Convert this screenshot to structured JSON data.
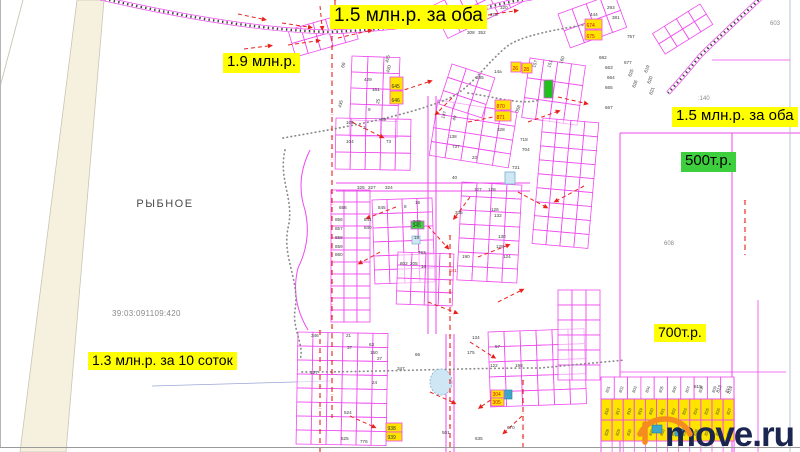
{
  "map": {
    "place_label": "РЫБНОЕ",
    "cadastral_number": "39:03:091109:420",
    "price_labels": [
      {
        "text": "1.5 млн.р. за оба",
        "x": 330,
        "y": 5,
        "fs": 19,
        "bg": "yellow"
      },
      {
        "text": "1.9 млн.р.",
        "x": 223,
        "y": 53,
        "fs": 15,
        "bg": "yellow"
      },
      {
        "text": "1.5 млн.р. за оба",
        "x": 672,
        "y": 107,
        "fs": 15,
        "bg": "yellow"
      },
      {
        "text": "500т.р.",
        "x": 681,
        "y": 152,
        "fs": 15,
        "bg": "green"
      },
      {
        "text": "700т.р.",
        "x": 654,
        "y": 324,
        "fs": 14,
        "bg": "yellow"
      },
      {
        "text": "1.3 млн.р. за 10 соток",
        "x": 88,
        "y": 352,
        "fs": 14,
        "bg": "yellow"
      }
    ],
    "area_codes": [
      {
        "t": "603",
        "x": 770,
        "y": 25
      },
      {
        "t": ":140",
        "x": 698,
        "y": 100
      },
      {
        "t": "608",
        "x": 664,
        "y": 245
      }
    ],
    "parcel_numbers": [
      [
        "429",
        364,
        81,
        0
      ],
      [
        "161",
        372,
        91,
        0
      ],
      [
        "435",
        341,
        108,
        -75
      ],
      [
        "60",
        344,
        68,
        -75
      ],
      [
        "425",
        388,
        63,
        -75
      ],
      [
        "420",
        389,
        73,
        -75
      ],
      [
        "25",
        379,
        104,
        -80
      ],
      [
        "9",
        368,
        111,
        0
      ],
      [
        "69",
        381,
        121,
        0
      ],
      [
        "105",
        346,
        124,
        0
      ],
      [
        "2",
        363,
        129,
        0
      ],
      [
        "104",
        346,
        143,
        0
      ],
      [
        "73",
        386,
        143,
        0
      ],
      [
        "14а",
        494,
        73,
        0
      ],
      [
        "285",
        476,
        79,
        0
      ],
      [
        "147",
        444,
        119,
        -70
      ],
      [
        "49",
        455,
        121,
        -70
      ],
      [
        "358",
        518,
        113,
        -70
      ],
      [
        "328",
        497,
        131,
        0
      ],
      [
        "138",
        449,
        138,
        0
      ],
      [
        "737",
        452,
        148,
        0
      ],
      [
        "718",
        520,
        141,
        0
      ],
      [
        "704",
        522,
        151,
        0
      ],
      [
        "23",
        472,
        159,
        0
      ],
      [
        "731",
        512,
        169,
        0
      ],
      [
        "40",
        452,
        179,
        0
      ],
      [
        "656",
        339,
        209,
        0
      ],
      [
        "845",
        378,
        209,
        0
      ],
      [
        "325",
        357,
        189,
        0
      ],
      [
        "327",
        368,
        189,
        0
      ],
      [
        "324",
        385,
        189,
        0
      ],
      [
        "16",
        415,
        204,
        0
      ],
      [
        "8",
        404,
        208,
        0
      ],
      [
        "841",
        364,
        221,
        0
      ],
      [
        "840",
        364,
        229,
        0
      ],
      [
        "856",
        335,
        221,
        0
      ],
      [
        "857",
        335,
        230,
        0
      ],
      [
        "858",
        335,
        239,
        0
      ],
      [
        "859",
        335,
        248,
        0
      ],
      [
        "860",
        335,
        256,
        0
      ],
      [
        "348",
        413,
        223,
        0
      ],
      [
        "19",
        414,
        239,
        0
      ],
      [
        "127",
        474,
        191,
        0
      ],
      [
        "128",
        488,
        191,
        0
      ],
      [
        "126",
        491,
        211,
        0
      ],
      [
        "132",
        494,
        217,
        0
      ],
      [
        "130",
        498,
        238,
        0
      ],
      [
        "129",
        496,
        248,
        0
      ],
      [
        "124",
        503,
        258,
        0
      ],
      [
        "335",
        455,
        214,
        0
      ],
      [
        "190",
        462,
        258,
        0
      ],
      [
        "763",
        418,
        254,
        0
      ],
      [
        "802",
        400,
        265,
        0
      ],
      [
        "205",
        410,
        265,
        0
      ],
      [
        "16",
        421,
        268,
        0
      ],
      [
        "841",
        449,
        272,
        0,
        "#e02020"
      ],
      [
        "346",
        311,
        337,
        0
      ],
      [
        "21",
        346,
        337,
        0
      ],
      [
        "37",
        347,
        349,
        0
      ],
      [
        "63",
        369,
        346,
        0
      ],
      [
        "150",
        370,
        354,
        0
      ],
      [
        "27",
        377,
        360,
        0
      ],
      [
        "347",
        397,
        370,
        0
      ],
      [
        "24",
        372,
        384,
        0
      ],
      [
        "127",
        310,
        374,
        0
      ],
      [
        "134",
        472,
        339,
        0
      ],
      [
        "175",
        467,
        354,
        0
      ],
      [
        "57",
        495,
        348,
        0
      ],
      [
        "122",
        490,
        367,
        0
      ],
      [
        "198",
        515,
        367,
        0
      ],
      [
        "66",
        415,
        356,
        0
      ],
      [
        "501",
        442,
        434,
        0
      ],
      [
        "670",
        507,
        429,
        0
      ],
      [
        "524",
        344,
        414,
        0
      ],
      [
        "525",
        341,
        440,
        0
      ],
      [
        "776",
        360,
        443,
        0
      ],
      [
        "635",
        475,
        440,
        0
      ],
      [
        "444",
        590,
        16,
        0
      ],
      [
        "293",
        607,
        9,
        0
      ],
      [
        "381",
        612,
        19,
        0
      ],
      [
        "375",
        490,
        16,
        0
      ],
      [
        "320",
        500,
        9,
        0
      ],
      [
        "308",
        467,
        34,
        0
      ],
      [
        "352",
        478,
        34,
        0
      ],
      [
        "757",
        627,
        38,
        0
      ],
      [
        "157",
        535,
        68,
        -70
      ],
      [
        "151",
        550,
        68,
        -70
      ],
      [
        "160",
        562,
        64,
        -70
      ],
      [
        "682",
        599,
        59,
        0
      ],
      [
        "663",
        605,
        69,
        0
      ],
      [
        "664",
        607,
        79,
        0
      ],
      [
        "665",
        605,
        89,
        0
      ],
      [
        "667",
        605,
        109,
        0
      ],
      [
        "677",
        624,
        64,
        0
      ],
      [
        "625",
        631,
        77,
        -70
      ],
      [
        "626",
        635,
        88,
        -70
      ],
      [
        "619",
        647,
        73,
        -70
      ],
      [
        "620",
        650,
        84,
        -70
      ],
      [
        "621",
        652,
        95,
        -70
      ],
      [
        "815",
        694,
        388,
        0
      ],
      [
        "813",
        719,
        393,
        -70
      ],
      [
        "814",
        730,
        394,
        -70
      ]
    ],
    "tags": [
      {
        "t": "674",
        "x": 585,
        "y": 19,
        "w": 17,
        "h": 10,
        "fill": "#ffe400",
        "tc": "#d01010"
      },
      {
        "t": "675",
        "x": 585,
        "y": 30,
        "w": 17,
        "h": 10,
        "fill": "#ffe400",
        "tc": "#d01010"
      },
      {
        "t": "870",
        "x": 495,
        "y": 100,
        "w": 16,
        "h": 10,
        "fill": "#ffe400",
        "tc": "#d01010"
      },
      {
        "t": "871",
        "x": 495,
        "y": 111,
        "w": 16,
        "h": 10,
        "fill": "#ffe400",
        "tc": "#d01010"
      },
      {
        "t": "645",
        "x": 390,
        "y": 77,
        "w": 13,
        "h": 13,
        "fill": "#ffe400",
        "tc": "#333333"
      },
      {
        "t": "646",
        "x": 390,
        "y": 91,
        "w": 13,
        "h": 13,
        "fill": "#ffe400",
        "tc": "#333333"
      },
      {
        "t": "26",
        "x": 511,
        "y": 62,
        "w": 10,
        "h": 10,
        "fill": "#ffe400",
        "tc": "#d01010"
      },
      {
        "t": "28",
        "x": 522,
        "y": 63,
        "w": 10,
        "h": 10,
        "fill": "#ffe400",
        "tc": "#d01010"
      },
      {
        "t": "938",
        "x": 386,
        "y": 423,
        "w": 16,
        "h": 9,
        "fill": "#ffe400",
        "tc": "#333333"
      },
      {
        "t": "939",
        "x": 386,
        "y": 432,
        "w": 16,
        "h": 9,
        "fill": "#ffe400",
        "tc": "#333333"
      },
      {
        "t": "304",
        "x": 491,
        "y": 390,
        "w": 13,
        "h": 8,
        "fill": "#ffe400",
        "tc": "#d01010"
      },
      {
        "t": "305",
        "x": 491,
        "y": 398,
        "w": 13,
        "h": 8,
        "fill": "#ffe400",
        "tc": "#d01010"
      },
      {
        "t": "",
        "x": 544,
        "y": 80,
        "w": 9,
        "h": 18,
        "fill": "#1dc21d",
        "tc": "#333333"
      },
      {
        "t": "345",
        "x": 411,
        "y": 221,
        "w": 13,
        "h": 8,
        "fill": "#3ed43e",
        "tc": "#333333"
      }
    ],
    "yellow_block": {
      "x": 601,
      "y": 399,
      "cell_w": 11.1,
      "cell_h": 21,
      "top_white_row": [
        "801",
        "802",
        "803",
        "804",
        "805",
        "806",
        "807",
        "808",
        "809",
        "810"
      ],
      "rows": [
        [
          "816",
          "817",
          "818",
          "819",
          "820",
          "821",
          "822",
          "823",
          "824",
          "825",
          "826",
          "827"
        ],
        [
          "828",
          "829",
          "830",
          "831",
          "832",
          "833",
          "834",
          "835",
          "836",
          "837",
          "838",
          "839"
        ]
      ]
    },
    "colors": {
      "pink": "#ef49ef",
      "pink_light": "#f9a0f9",
      "red": "#e8201c",
      "label_yellow": "#ffff00",
      "label_green": "#3ecf3e",
      "block_yellow": "#ffe400",
      "beige": "#f6f1df",
      "beige_border": "#c9c5b4",
      "gray_dots": "#8a8a8a",
      "rail_dark": "#3f3f3f",
      "number": "#3a3a3a",
      "area_code": "#8a8a8a",
      "pond_fill": "#cfe7f4",
      "pond_stroke": "#79aed2",
      "teal": "#3da6c9",
      "watermark_text": "#1a2550",
      "watermark_house": "#f68b1f"
    }
  },
  "watermark": {
    "text": "move.ru"
  }
}
